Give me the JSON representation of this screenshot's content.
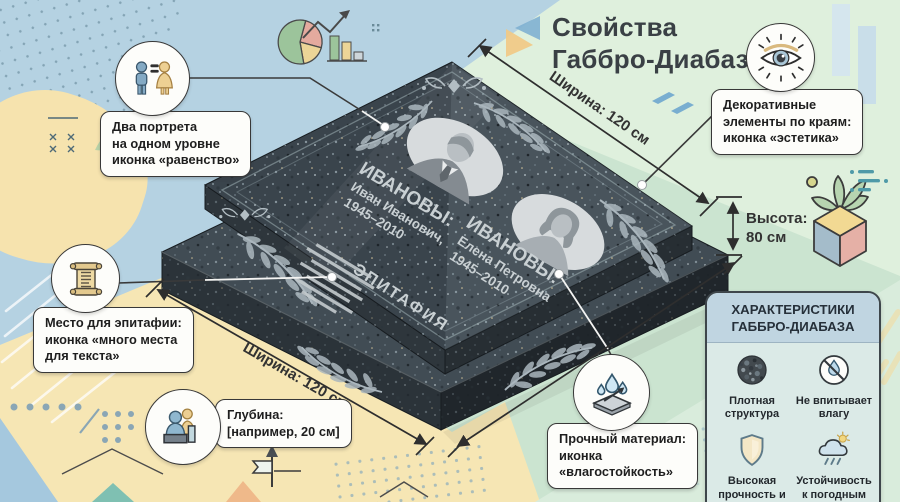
{
  "title": {
    "line1": "Свойства",
    "line2": "Габбро-Диабаз"
  },
  "dimensions": {
    "width_top": "Ширина: 120 см",
    "width_bottom": "Ширина: 120 см",
    "height_line1": "Высота:",
    "height_line2": "80 см"
  },
  "monument": {
    "left_person": {
      "surname": "ИВАНОВЫ:",
      "name": "Иван Иванович,",
      "years": "1945–2010"
    },
    "right_person": {
      "surname": "ИВАНОВЫ:",
      "name": "Елена Петровна",
      "years": "1945–2010"
    },
    "epitaph": "ЭПИТАФИЯ"
  },
  "callouts": {
    "portraits": {
      "icon": "man-woman-equality-icon",
      "lines": [
        "Два портрета",
        "на одном уровне",
        "иконка «равенство»"
      ]
    },
    "decor": {
      "icon": "eye-icon",
      "lines": [
        "Декоративные",
        "элементы по краям:",
        "иконка «эстетика»"
      ]
    },
    "epitaph": {
      "icon": "scroll-icon",
      "lines": [
        "Место для эпитафии:",
        "иконка «много места",
        "для текста»"
      ]
    },
    "depth": {
      "icon": "people-depth-icon",
      "lines": [
        "Глубина:",
        "[например, 20 см]"
      ]
    },
    "material": {
      "icon": "water-drops-icon",
      "lines": [
        "Прочный материал:",
        "иконка",
        "«влагостойкость»"
      ]
    }
  },
  "panel": {
    "title_line1": "ХАРАКТЕРИСТИКИ",
    "title_line2": "ГАББРО-ДИАБАЗА",
    "features": [
      {
        "label": "Плотная структура",
        "icon": "dense-structure-icon"
      },
      {
        "label": "Не впитывает влагу",
        "icon": "no-water-absorption-icon"
      },
      {
        "label": "Высокая прочность и долговечность",
        "icon": "shield-durability-icon"
      },
      {
        "label": "Устойчивость к погодным условиям",
        "icon": "weather-resistance-icon"
      }
    ]
  },
  "colors": {
    "stone": "#3a444c",
    "mint": "#cbe4d0",
    "blue": "#b5d2e2",
    "yellow": "#f6e6b4",
    "engraving": "#c3cacd",
    "callout_border": "#383838",
    "title_text": "#3a4045"
  }
}
